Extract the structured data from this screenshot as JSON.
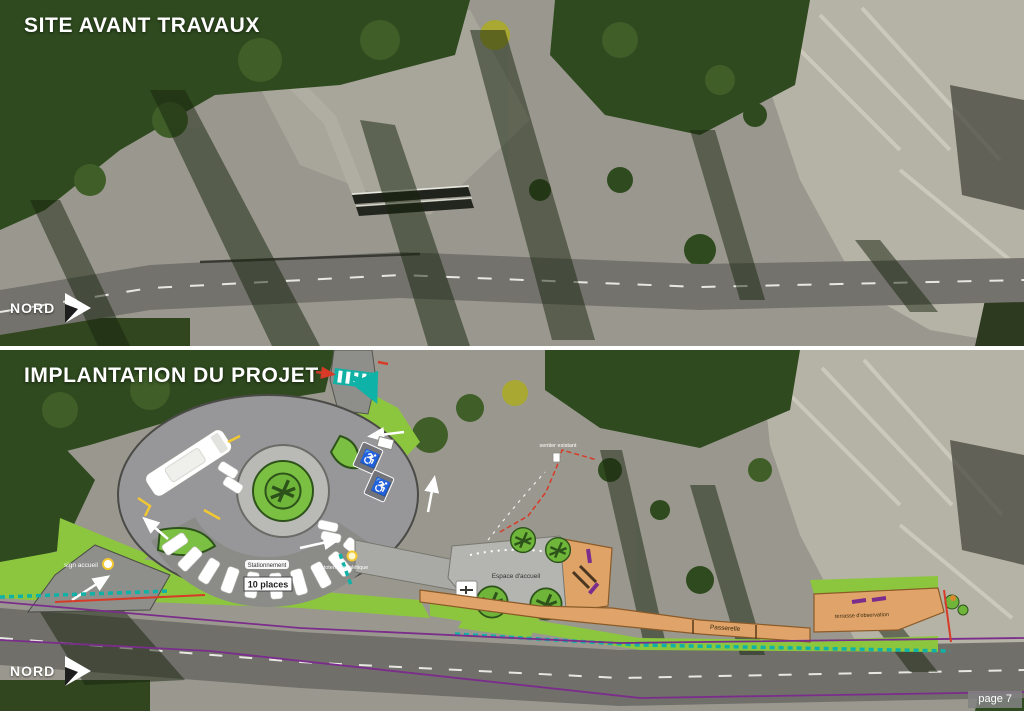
{
  "panel_before": {
    "title": "SITE AVANT TRAVAUX",
    "north_label": "NORD"
  },
  "panel_project": {
    "title": "IMPLANTATION DU PROJET",
    "north_label": "NORD",
    "labels": {
      "parking_zone": "Stationnement",
      "parking_count": "10 places",
      "welcome_sign": "sign accueil",
      "totem": "totem signalétique",
      "welcome_area": "Espace d'accueil",
      "footbridge": "Passerelle",
      "observation_terrace": "terrasse d'observation",
      "existing_trail": "sentier existant"
    },
    "icons": {
      "accessible_parking": "♿"
    }
  },
  "footer": {
    "page_label": "page 7"
  },
  "colors": {
    "lawn_green": "#8cc63e",
    "bed_green": "#7cc043",
    "walkway_orange": "#e0a46a",
    "path_teal": "#0eb2a6",
    "line_purple": "#7b2d8b",
    "line_red": "#d83a28",
    "accent_yellow": "#f2c832",
    "plan_gray": "#97979a"
  }
}
